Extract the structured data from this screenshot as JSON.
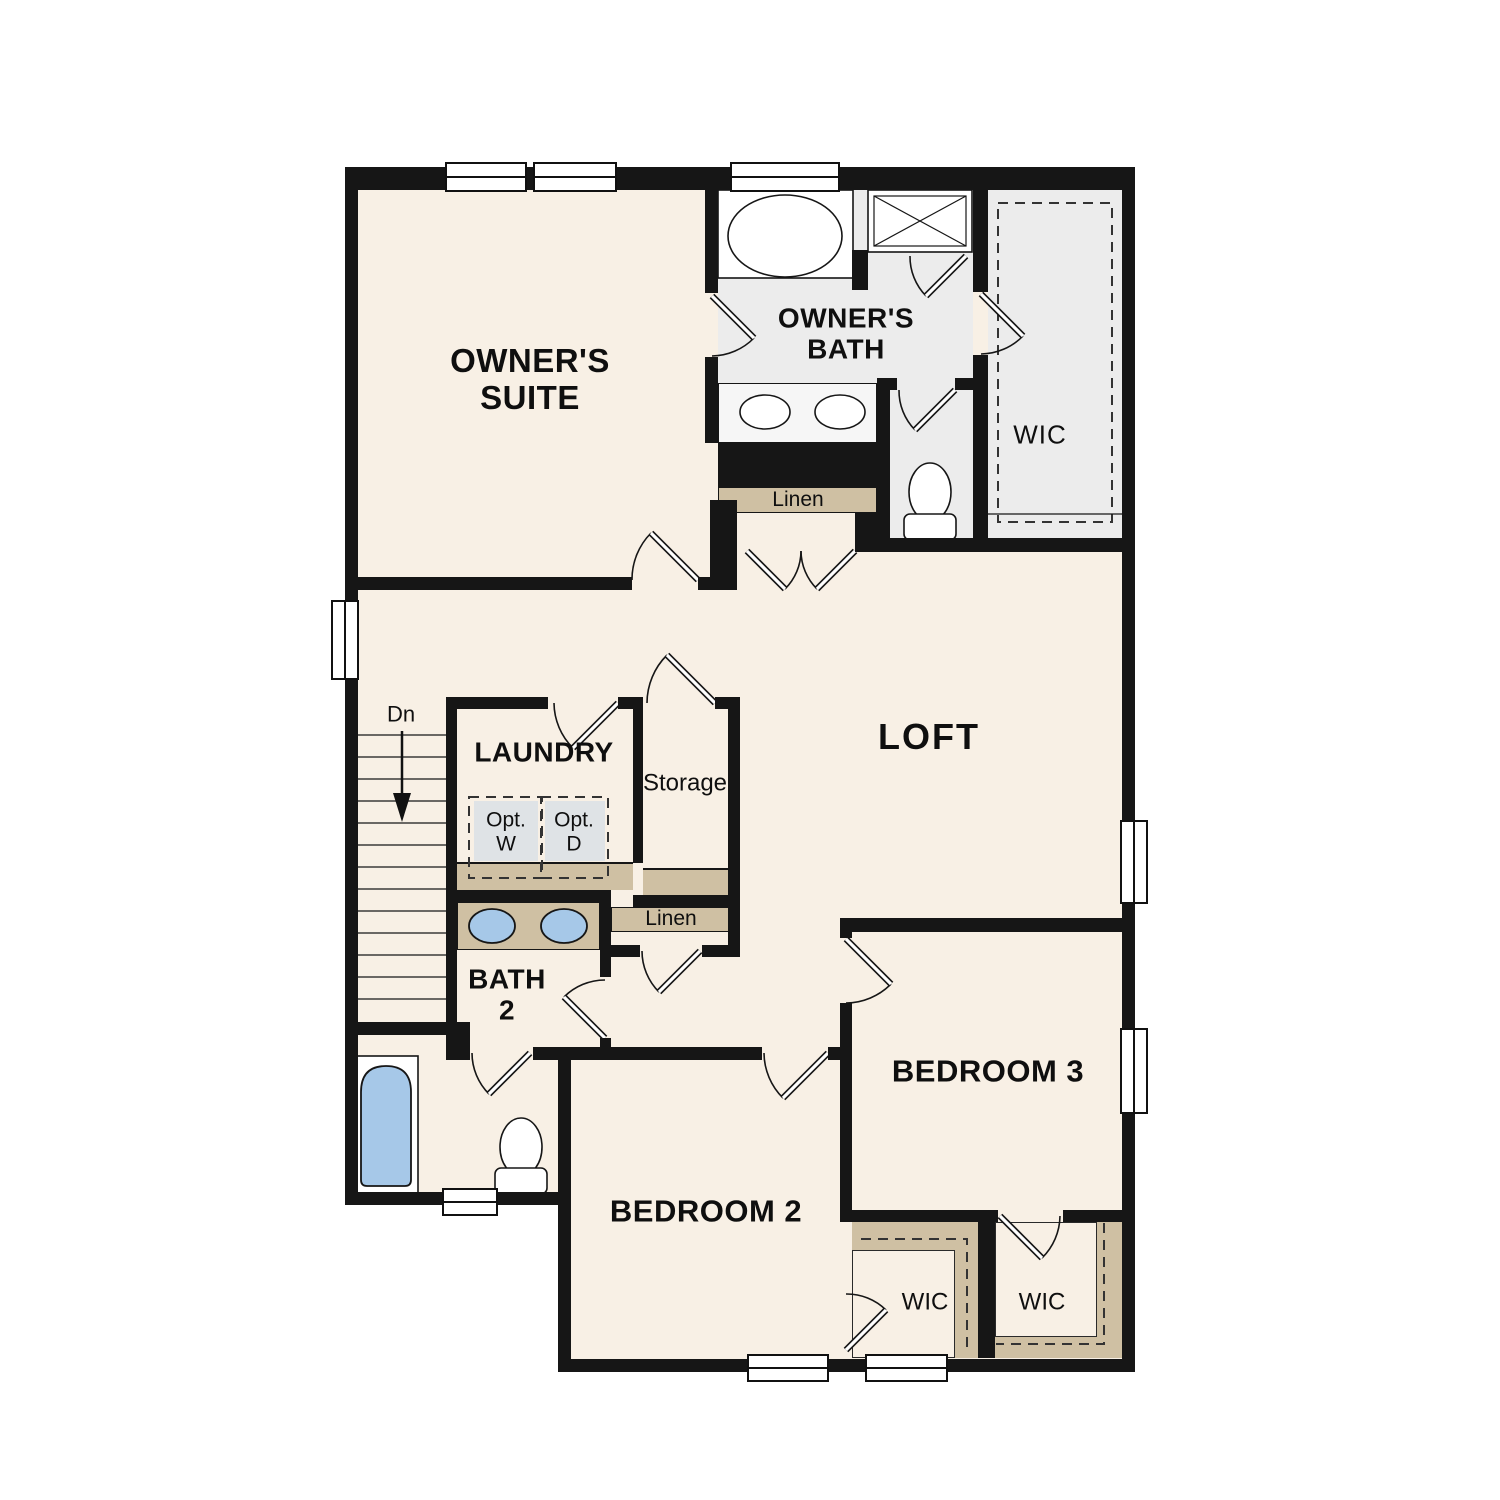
{
  "floorplan": {
    "rooms": {
      "owners_suite": "OWNER'S\nSUITE",
      "owners_bath": "OWNER'S\nBATH",
      "owners_wic": "WIC",
      "owners_linen": "Linen",
      "loft": "LOFT",
      "laundry": "LAUNDRY",
      "storage": "Storage",
      "hall_linen": "Linen",
      "bath2": "BATH\n2",
      "bedroom2": "BEDROOM 2",
      "bedroom3": "BEDROOM 3",
      "bedroom2_wic": "WIC",
      "bedroom3_wic": "WIC"
    },
    "annotations": {
      "stairs_down": "Dn",
      "opt_washer": "Opt.\nW",
      "opt_dryer": "Opt.\nD"
    },
    "fixtures": [
      "garden-tub-icon",
      "shower-icon",
      "double-vanity-sinks-icon",
      "toilet-icon",
      "bathtub-icon",
      "washer-dryer-boxes-icon",
      "stairs-down-arrow-icon",
      "door-swing-icon",
      "window-icon",
      "closet-shelving-dashed-icon"
    ],
    "colors": {
      "wall": "#161616",
      "room_floor": "#f8f0e5",
      "bath_floor": "#ececec",
      "shelf_tan": "#cfc0a3",
      "fixture_blue": "#a6c8e8",
      "appliance_gray": "#dfe3e6",
      "background": "#ffffff"
    }
  }
}
